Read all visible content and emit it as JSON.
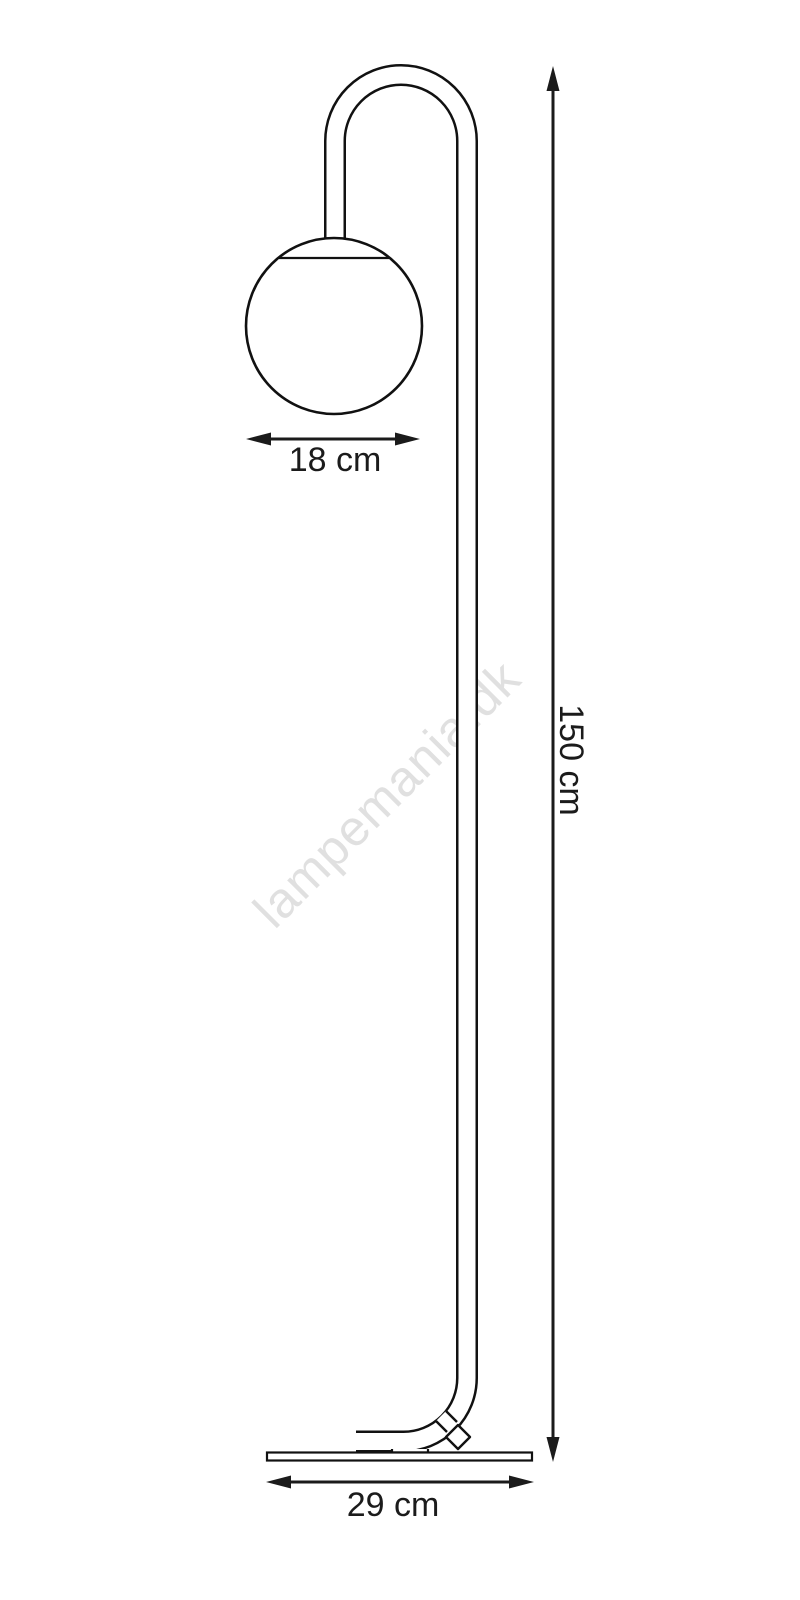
{
  "diagram": {
    "type": "product-dimension-drawing",
    "subject": "floor lamp with globe shade",
    "watermark": {
      "text": "lampemania.dk",
      "color": "#e0e0e0"
    },
    "colors": {
      "background": "#ffffff",
      "line": "#111111",
      "dimension": "#1b1b1b",
      "label": "#1b1b1b"
    },
    "dimensions": {
      "shade_width": {
        "value": "18",
        "unit": "cm",
        "label": "18 cm"
      },
      "height": {
        "value": "150",
        "unit": "cm",
        "label": "150 cm"
      },
      "base_width": {
        "value": "29",
        "unit": "cm",
        "label": "29 cm"
      }
    }
  }
}
